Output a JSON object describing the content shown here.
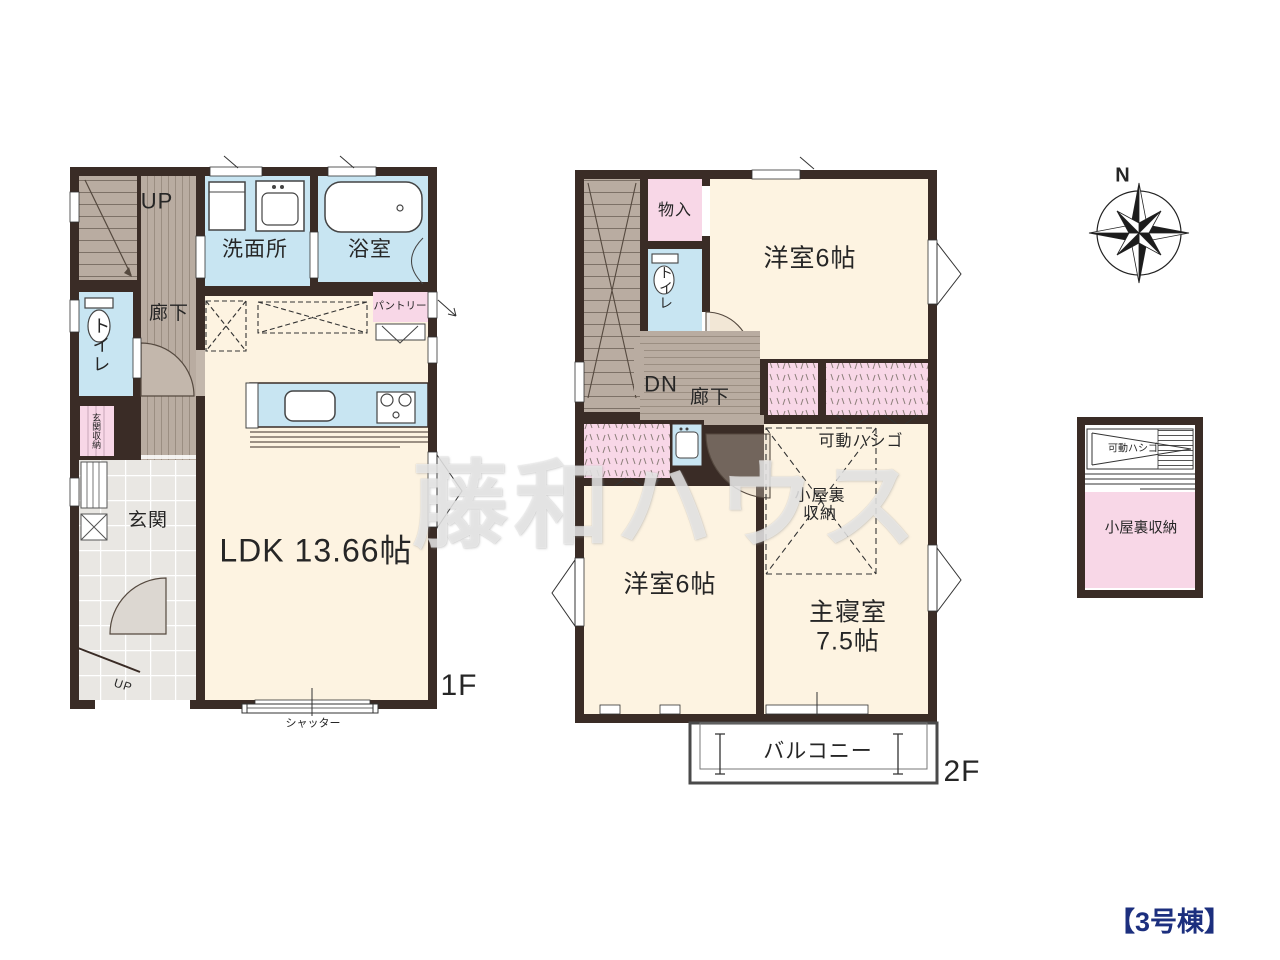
{
  "watermark": "藤和ハウス",
  "building_label": "【3号棟】",
  "compass": {
    "north": "N"
  },
  "colors": {
    "wall": "#3a2c26",
    "room_floor": "#fdf3e1",
    "wet_area": "#c8e5f2",
    "storage_pink": "#f8d7e7",
    "wood_floor": "#b9aca1",
    "entrance_tile": "#e9e7e3",
    "building_navy": "#1c2f7e"
  },
  "floor1": {
    "floor_label": "1F",
    "stairs_up": "UP",
    "washroom": "洗面所",
    "bath": "浴室",
    "hallway": "廊下",
    "toilet": "トイレ",
    "entrance_storage": "玄関収納",
    "entrance": "玄関",
    "porch_up": "UP",
    "pantry": "パントリー",
    "ldk": "LDK 13.66帖",
    "shutter": "シャッター"
  },
  "floor2": {
    "floor_label": "2F",
    "storage": "物入",
    "toilet": "トイレ",
    "bedroom_a": "洋室6帖",
    "stairs_down": "DN",
    "hallway": "廊下",
    "ladder": "可動ハシゴ",
    "attic": "小屋裏\n収納",
    "bedroom_b": "洋室6帖",
    "master_bedroom": "主寝室\n7.5帖",
    "balcony": "バルコニー"
  },
  "attic_detail": {
    "ladder": "可動ハシゴ",
    "name": "小屋裏収納"
  }
}
